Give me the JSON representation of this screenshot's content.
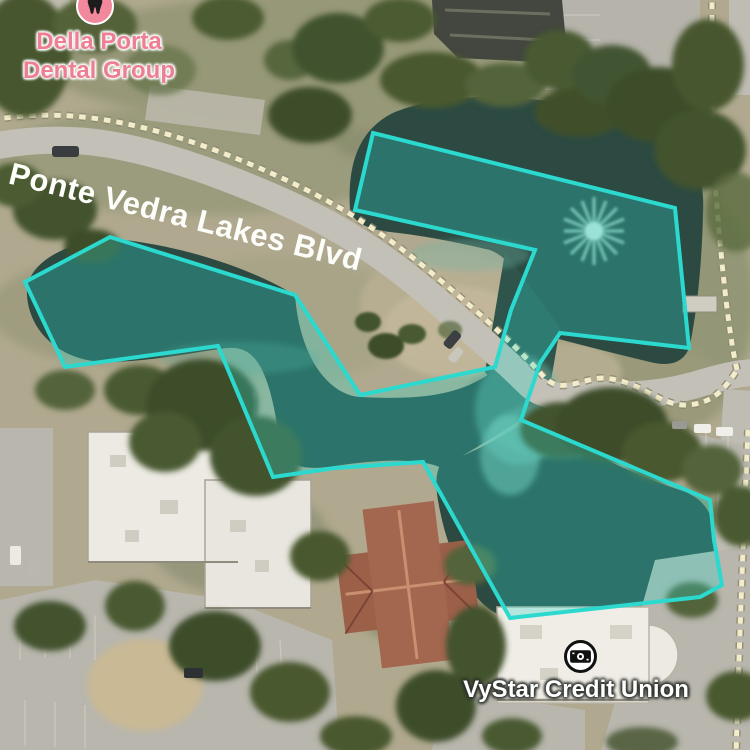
{
  "map": {
    "street": {
      "name": "Ponte Vedra Lakes Blvd"
    },
    "pois": {
      "dental": {
        "name_line1": "Della Porta",
        "name_line2": "Dental Group",
        "icon": "tooth-icon",
        "label_color": "#ee7e93",
        "icon_bg": "#f2889b"
      },
      "vystar": {
        "name": "VyStar Credit Union",
        "icon": "banknote-icon",
        "label_color": "#ffffff"
      }
    },
    "overlay": {
      "kind": "highlighted-water-polygon",
      "stroke": "#2bd9ce",
      "fill": "rgba(46,216,203,0.30)",
      "stroke_width": "4",
      "points": "373,133 675,208 689,348 560,333 540,363 521,420 710,500 714,540 722,585 700,597 510,618 423,462 335,468 273,477 218,346 65,367 25,282 110,237 295,295 360,395 495,367 511,310 535,250 355,210"
    }
  }
}
